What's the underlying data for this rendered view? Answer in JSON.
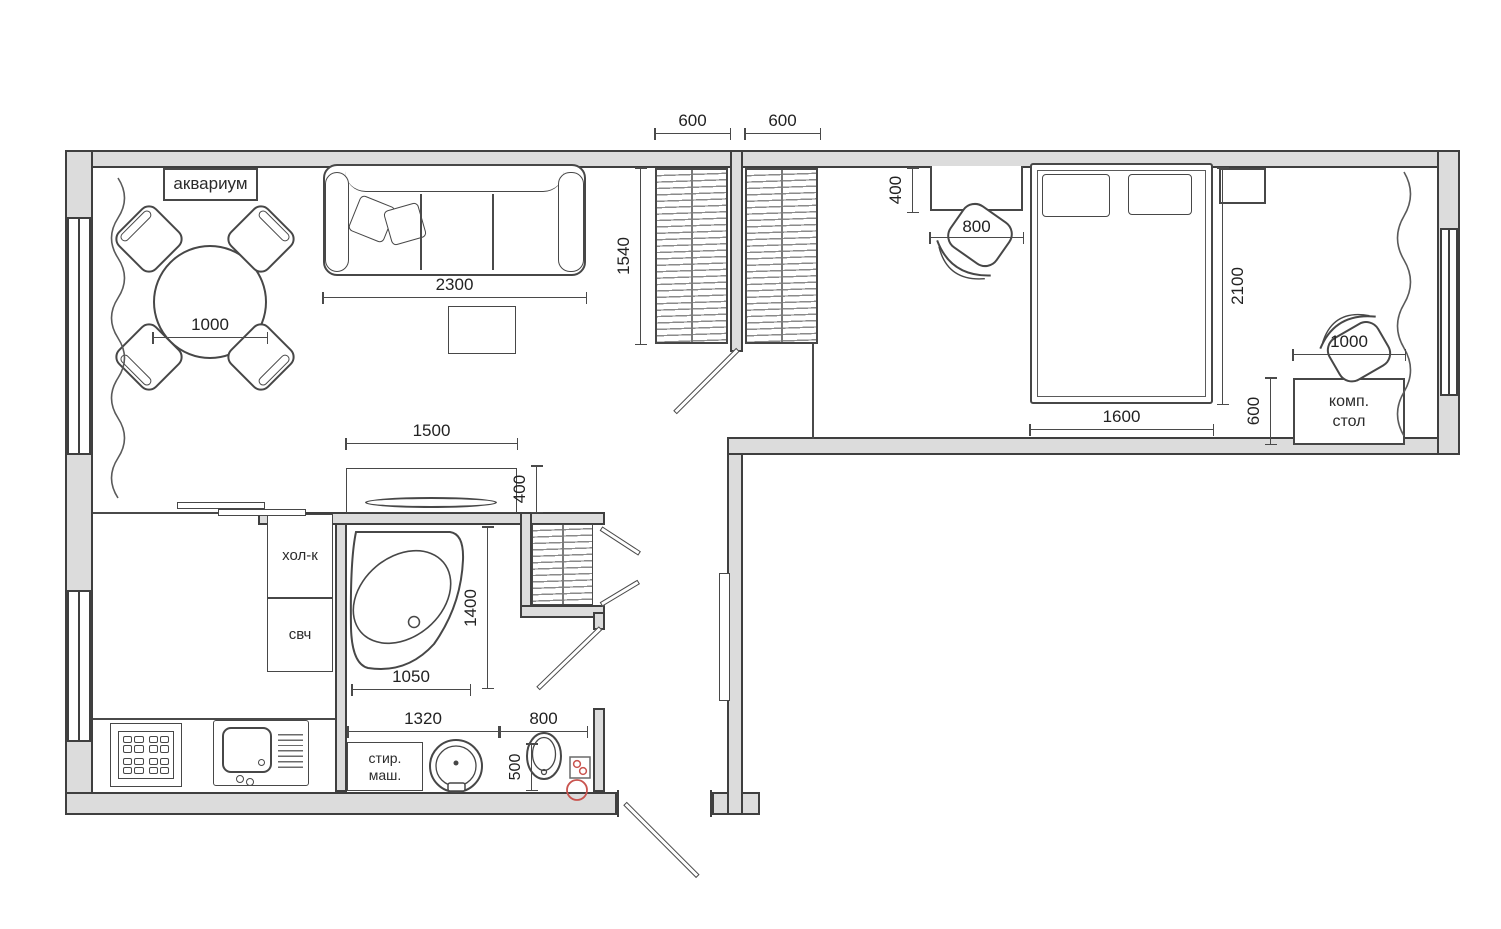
{
  "colors": {
    "wall_fill": "#dcdcdc",
    "line": "#3f3f3f",
    "dim_text": "#222222",
    "accent_red": "#c9544f"
  },
  "labels": {
    "aquarium": "аквариум",
    "fridge": "хол-к",
    "microwave": "свч",
    "washer_l1": "стир.",
    "washer_l2": "маш.",
    "desk_l1": "комп.",
    "desk_l2": "стол"
  },
  "dims": {
    "wardrobe_left": "600",
    "wardrobe_right": "600",
    "wardrobe_depth": "1540",
    "bedroom_desk_depth": "400",
    "bedroom_desk_width": "800",
    "bed_length": "2100",
    "bed_width": "1600",
    "computer_desk_width": "1000",
    "computer_desk_depth": "600",
    "sofa_width": "2300",
    "dining_table": "1000",
    "tv_console_width": "1500",
    "tv_console_depth": "400",
    "bathtub_length": "1400",
    "bathtub_width": "1050",
    "washer_basin_row": "1320",
    "toilet_zone_width": "800",
    "toilet_zone_depth": "500"
  }
}
